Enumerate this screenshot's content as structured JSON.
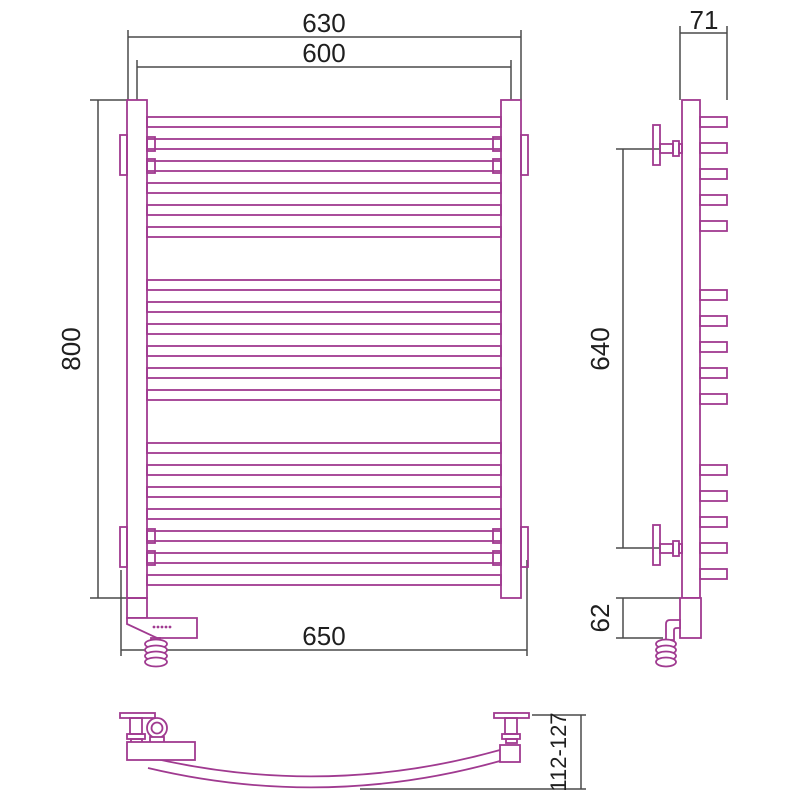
{
  "document": {
    "type": "technical-drawing",
    "subject": "curved electric heated towel rail — orthographic projection with dimensions"
  },
  "colors": {
    "product-outline": "#a03a90",
    "dimension-line": "#4a4a4a",
    "label-text": "#1f1f1f",
    "background": "#ffffff"
  },
  "views": {
    "front": {
      "name": "front view",
      "dims": {
        "width_outer": "630",
        "width_centers": "600",
        "height": "800",
        "width_bottom": "650"
      }
    },
    "side": {
      "name": "side view",
      "dims": {
        "depth": "71",
        "bracket_spacing": "640",
        "heater_section": "62"
      }
    },
    "plan": {
      "name": "bottom view",
      "dims": {
        "depth_range": "112-127"
      }
    }
  }
}
